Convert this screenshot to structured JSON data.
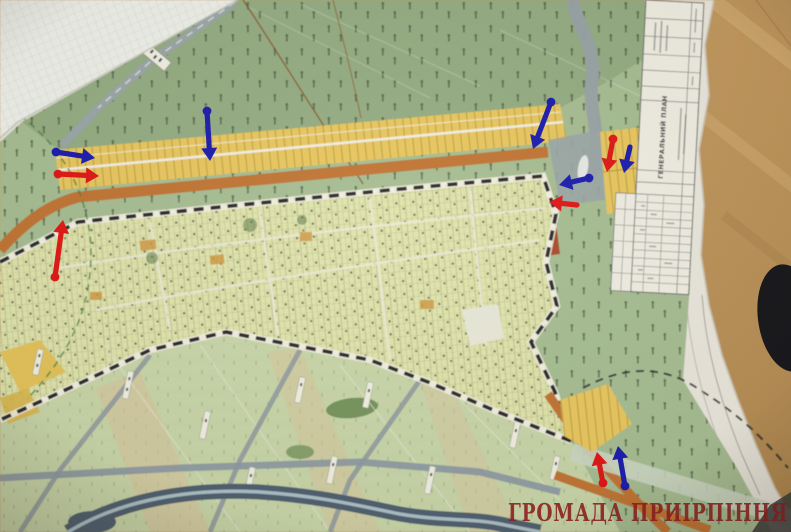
{
  "texts": {
    "watermark": "ГРОМАДА ПРИІРПІННЯ",
    "title_block_title": "ГЕНЕРАЛЬНИЙ ПЛАН"
  },
  "palette": {
    "red": "#df1717",
    "blue": "#1b1cae",
    "wood": "#c39a62",
    "paper": "#e9e6dd",
    "forest_green": "#a6bd93",
    "settlement_fill": "#e0e4ac",
    "allotment_yellow": "#e8c75f",
    "boundary_orange": "#c07434",
    "river": "#4f6070",
    "watermark_red": "#8f1d1f"
  },
  "annotations": {
    "arrows": [
      {
        "id": "west-blue-east",
        "color": "blue",
        "x1": 56,
        "y1": 152,
        "x2": 95,
        "y2": 158,
        "dot": true
      },
      {
        "id": "west-red-east",
        "color": "red",
        "x1": 58,
        "y1": 174,
        "x2": 99,
        "y2": 176,
        "dot": true
      },
      {
        "id": "west-red-north",
        "color": "red",
        "x1": 55,
        "y1": 277,
        "x2": 63,
        "y2": 220,
        "dot": true
      },
      {
        "id": "north-blue-south",
        "color": "blue",
        "x1": 207,
        "y1": 111,
        "x2": 210,
        "y2": 161,
        "dot": true
      },
      {
        "id": "east-blue-southwest",
        "color": "blue",
        "x1": 551,
        "y1": 102,
        "x2": 533,
        "y2": 149,
        "dot": true
      },
      {
        "id": "east-red-south",
        "color": "red",
        "x1": 613,
        "y1": 139,
        "x2": 607,
        "y2": 172,
        "dot": true
      },
      {
        "id": "east-blue-south",
        "color": "blue",
        "x1": 630,
        "y1": 147,
        "x2": 624,
        "y2": 173,
        "dot": false
      },
      {
        "id": "east-blue-west",
        "color": "blue",
        "x1": 589,
        "y1": 178,
        "x2": 559,
        "y2": 185,
        "dot": true
      },
      {
        "id": "east-red-west",
        "color": "red",
        "x1": 577,
        "y1": 205,
        "x2": 549,
        "y2": 202,
        "dot": false
      },
      {
        "id": "southeast-red-north",
        "color": "red",
        "x1": 603,
        "y1": 483,
        "x2": 597,
        "y2": 452,
        "dot": true
      },
      {
        "id": "southeast-blue-north",
        "color": "blue",
        "x1": 625,
        "y1": 486,
        "x2": 618,
        "y2": 446,
        "dot": true
      }
    ]
  }
}
